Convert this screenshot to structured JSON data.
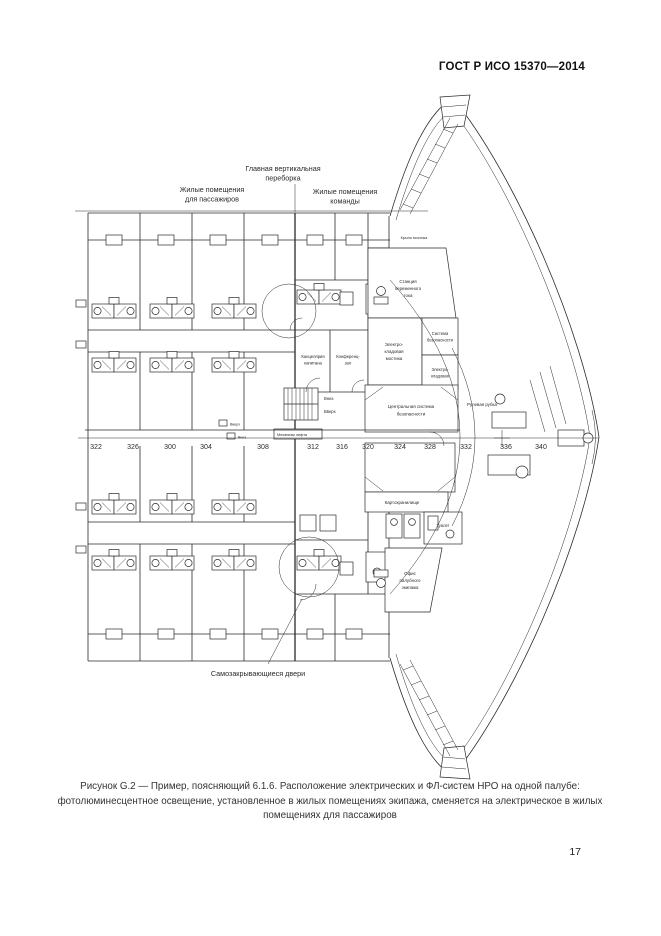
{
  "page": {
    "header": "ГОСТ Р ИСО 15370—2014",
    "caption": "Рисунок G.2 — Пример, поясняющий 6.1.6. Расположение электрических и ФЛ-систем НРО на одной палубе: фотолюминесцентное освещение, установленное в жилых помещениях экипажа, сменяется на электрическое в жилых помещениях для пассажиров",
    "page_number": "17"
  },
  "diagram": {
    "annotations": {
      "bulkhead": [
        "Главная вертикальная",
        "переборка"
      ],
      "passengers": [
        "Жилые помещения",
        "для пассажиров"
      ],
      "crew": [
        "Жилые помещения",
        "команды"
      ],
      "self_closing_doors": "Самозакрывающиеся двери"
    },
    "rooms": {
      "captain_office": [
        "Канцелярия",
        "капитана"
      ],
      "conference": [
        "Конференц-",
        "зал"
      ],
      "ac_station": [
        "Станция",
        "переменного",
        "тока"
      ],
      "bridge_elec_store": [
        "Электро-",
        "кладовая",
        "мостика"
      ],
      "security_system": [
        "Система",
        "безопасности"
      ],
      "elec_store": [
        "Электро-",
        "кладовая"
      ],
      "central_security": [
        "Центральная система",
        "безопасности"
      ],
      "wheelhouse": "Рулевая рубка",
      "chart_room": "Картохранилище",
      "toilet": "Туалет",
      "deck_office": [
        "Офис",
        "палубного",
        "экипажа"
      ],
      "lift": "Механизм лифта",
      "bridge_wing": "Крыло мостика",
      "up": "Вверх",
      "down": "Вниз"
    },
    "frame_numbers": [
      "322",
      "326",
      "300",
      "304",
      "308",
      "312",
      "316",
      "320",
      "324",
      "328",
      "332",
      "336",
      "340"
    ]
  }
}
